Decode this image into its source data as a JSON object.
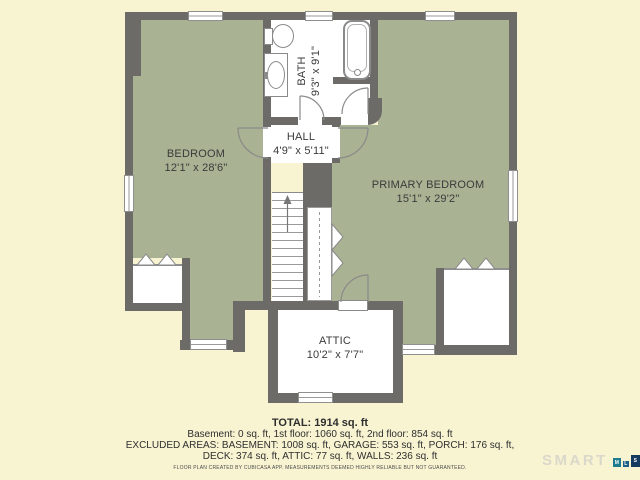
{
  "plan": {
    "rooms": [
      {
        "name": "BEDROOM",
        "dims": "12'1\" x 28'6\""
      },
      {
        "name": "BATH",
        "dims": "9'3\" x 9'1\""
      },
      {
        "name": "HALL",
        "dims": "4'9\" x 5'11\""
      },
      {
        "name": "PRIMARY BEDROOM",
        "dims": "15'1\" x 29'2\""
      },
      {
        "name": "ATTIC",
        "dims": "10'2\" x 7'7\""
      }
    ],
    "colors": {
      "wall": "#6d6b67",
      "room_fill": "#a9b293",
      "background": "#f8f4d2",
      "room_white": "#ffffff"
    }
  },
  "summary": {
    "total": "TOTAL: 1914 sq. ft",
    "floors": "Basement: 0 sq. ft, 1st floor: 1060 sq. ft, 2nd floor: 854 sq. ft",
    "excluded1": "EXCLUDED AREAS: BASEMENT: 1008 sq. ft, GARAGE: 553 sq. ft, PORCH: 176 sq. ft,",
    "excluded2": "DECK: 374 sq. ft, ATTIC: 77 sq. ft, WALLS: 236 sq. ft",
    "disclaimer": "FLOOR PLAN CREATED BY CUBICASA APP. MEASUREMENTS DEEMED HIGHLY RELIABLE BUT NOT GUARANTEED."
  },
  "logo": {
    "text": "SMART",
    "tiles": [
      {
        "letter": "M",
        "color": "#1d7b8e"
      },
      {
        "letter": "L",
        "color": "#1e5f86"
      },
      {
        "letter": "S",
        "color": "#16395f"
      }
    ]
  }
}
